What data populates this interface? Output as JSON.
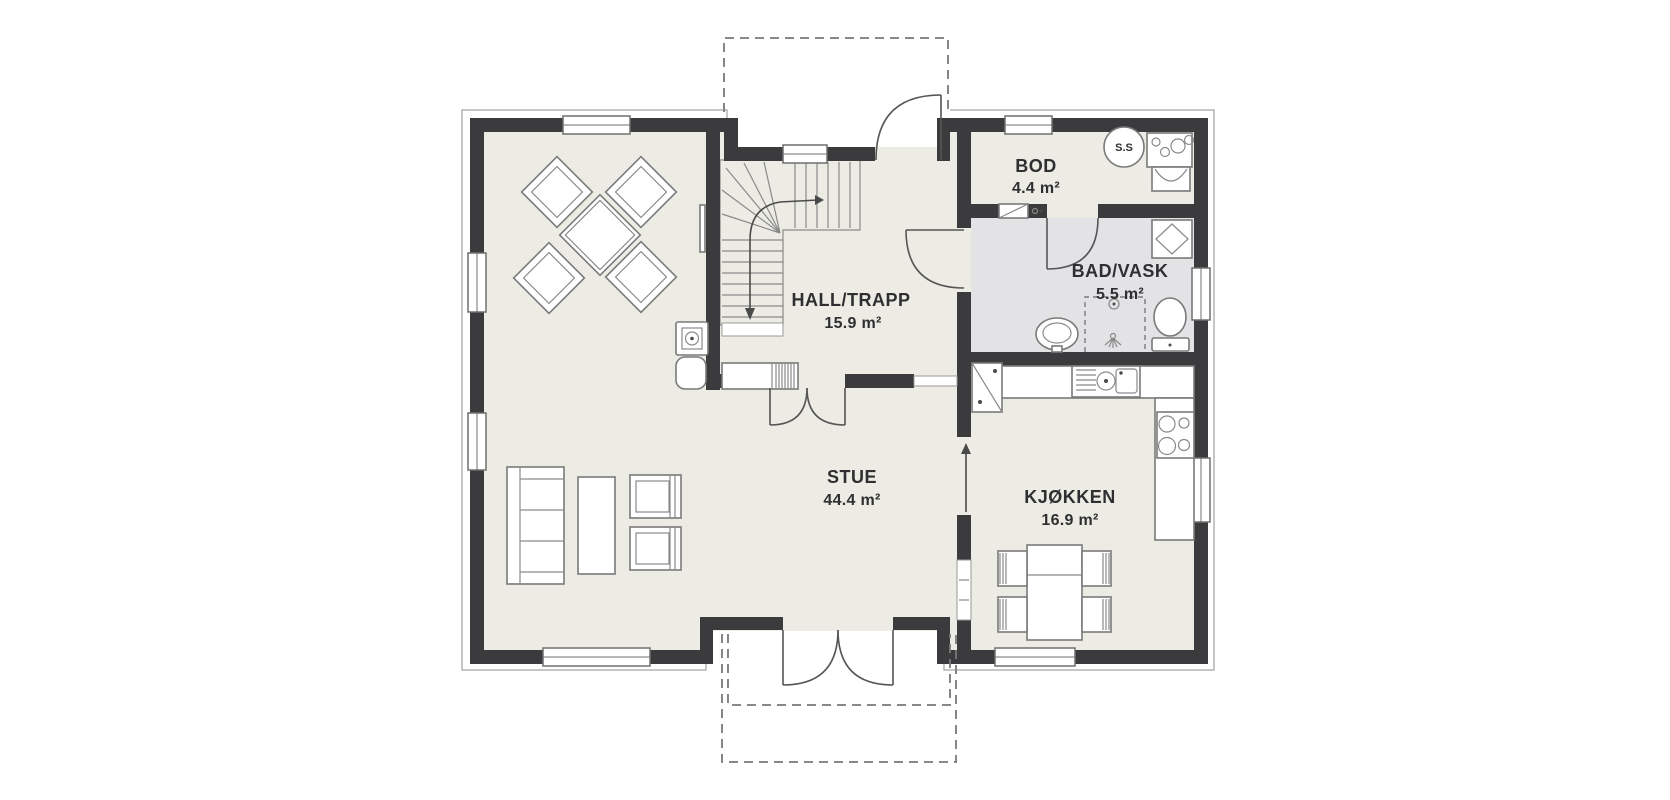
{
  "page": {
    "background": "#ffffff",
    "type": "floor-plan"
  },
  "palette": {
    "wall": "#3b3b3d",
    "floor": "#ecebe4",
    "bath_floor": "#e3e3e6",
    "furniture_line": "#7a7a7a",
    "outline": "#b3b3b3",
    "text": "#2f2f31"
  },
  "rooms": [
    {
      "name": "STUE",
      "area": "44.4 m²"
    },
    {
      "name": "KJØKKEN",
      "area": "16.9 m²"
    },
    {
      "name": "HALL/TRAPP",
      "area": "15.9 m²"
    },
    {
      "name": "BOD",
      "area": "4.4 m²"
    },
    {
      "name": "BAD/VASK",
      "area": "5.5 m²"
    }
  ],
  "annotations": {
    "water_heater_label": "S.S"
  },
  "fixtures": [
    "dining-table",
    "dining-chairs",
    "sofa",
    "coffee-table",
    "armchairs",
    "fireplace",
    "tv",
    "stair",
    "wardrobe",
    "kitchen-counter",
    "kitchen-sink",
    "dishwasher",
    "stove",
    "kitchen-table",
    "kitchen-chairs",
    "bath-sink",
    "toilet",
    "shower",
    "washing-machine",
    "water-heater",
    "laundry-sink",
    "electrical-cabinet",
    "entrance-door",
    "terrace-doors",
    "porch-dashed",
    "terrace-dashed"
  ]
}
